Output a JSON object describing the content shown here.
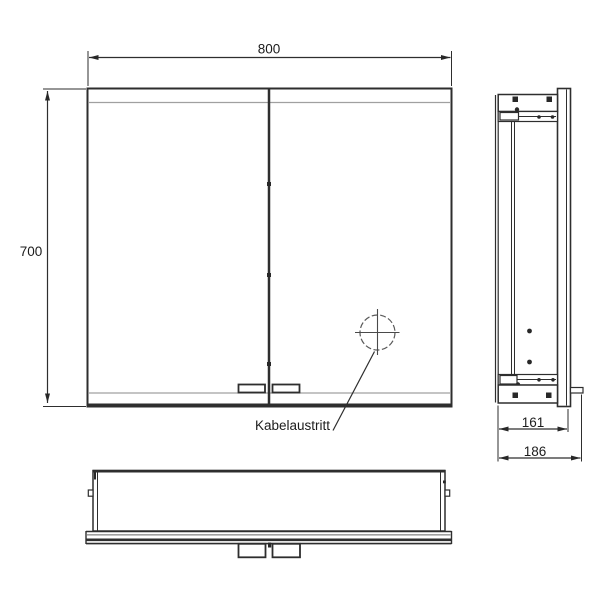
{
  "labels": {
    "width": "800",
    "height": "700",
    "depth_body": "161",
    "depth_total": "186",
    "cable_outlet": "Kabelaustritt"
  },
  "icons": {
    "cable_outlet_marker": "crosshair-circle-icon"
  },
  "colors": {
    "line_dark": "#282828",
    "line_gray": "#a0a0a0",
    "background": "#ffffff"
  }
}
